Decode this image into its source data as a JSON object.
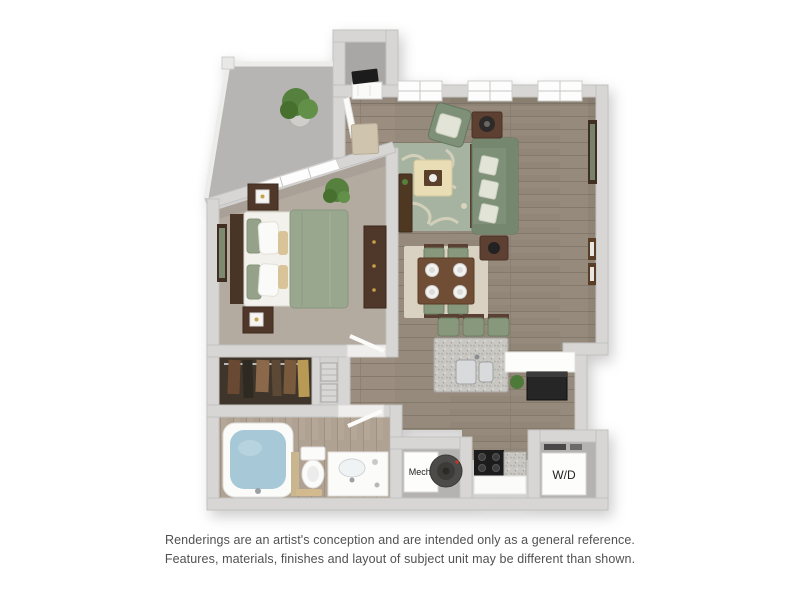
{
  "floorplan": {
    "labels": {
      "mech": "Mech.",
      "washer_dryer": "W/D"
    },
    "rooms": [
      "balcony",
      "entry",
      "living-room",
      "dining-area",
      "kitchen",
      "bedroom",
      "walk-in-closet",
      "linen-closet",
      "bathroom",
      "mechanical-closet",
      "laundry-closet"
    ],
    "colors": {
      "wall": "#d7d6d4",
      "wall_edge": "#c2c1bf",
      "wood_floor": "#968a7c",
      "carpet": "#b3aaa0",
      "bath_floor": "#b0a292",
      "closet_floor": "#3f362c",
      "balcony_floor": "#b6b5b3",
      "living_rug": "#a6b3a1",
      "dining_rug": "#d9d1c1",
      "upholstery_green": "#7e9178",
      "wood_furniture": "#54392b",
      "ottoman_cream": "#e9ddb6",
      "tub_water": "#a7c8d6",
      "granite": "#c9c7c2",
      "appliance_black": "#262626"
    }
  },
  "disclaimer": {
    "line1": "Renderings are an artist's conception and are intended only as a general reference.",
    "line2": "Features, materials, finishes and layout of subject unit may be different than shown."
  }
}
